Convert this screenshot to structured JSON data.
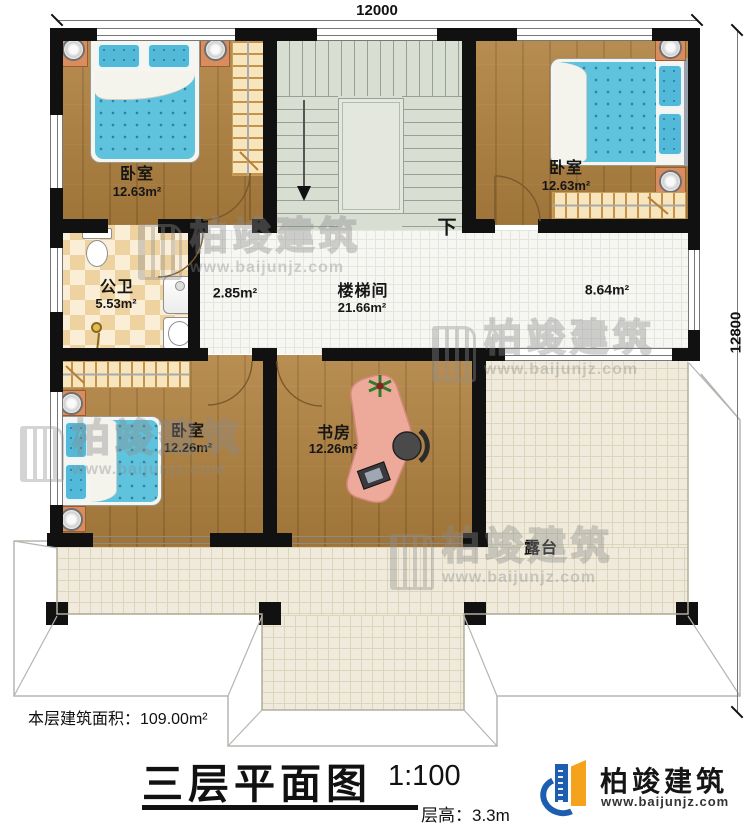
{
  "dimensions": {
    "top_width": "12000",
    "right_height": "12800"
  },
  "rooms": {
    "bedroom_tl": {
      "name": "卧室",
      "area": "12.63m²"
    },
    "bedroom_tr": {
      "name": "卧室",
      "area": "12.63m²"
    },
    "bathroom": {
      "name": "公卫",
      "area": "5.53m²"
    },
    "hall": {
      "area": "2.85m²"
    },
    "stairwell": {
      "name": "楼梯间",
      "area": "21.66m²"
    },
    "corridor": {
      "area": "8.64m²"
    },
    "bedroom_bl": {
      "name": "卧室",
      "area": "12.26m²"
    },
    "study": {
      "name": "书房",
      "area": "12.26m²"
    },
    "terrace": {
      "name": "露台"
    }
  },
  "annotations": {
    "stair_direction": "下"
  },
  "title_block": {
    "floor_area": "本层建筑面积：109.00m²",
    "plan_title": "三层平面图",
    "scale": "1:100",
    "floor_height": "层高：3.3m"
  },
  "brand": {
    "name": "柏竣建筑",
    "url": "www.baijunjz.com"
  },
  "watermark": {
    "name": "柏竣建筑",
    "url": "www.baijunjz.com"
  },
  "colors": {
    "wall": "#111111",
    "wood_floor": "#b0813f",
    "terrace_tile": "#efeadb",
    "stair": "#d9ded3",
    "mattress": "#5fc2de",
    "bathroom_tile": "#eed2a0",
    "desk": "#edaa9b",
    "logo_blue": "#1d5fae",
    "logo_orange": "#f5a21c",
    "watermark_gray": "#8f8f8f"
  }
}
